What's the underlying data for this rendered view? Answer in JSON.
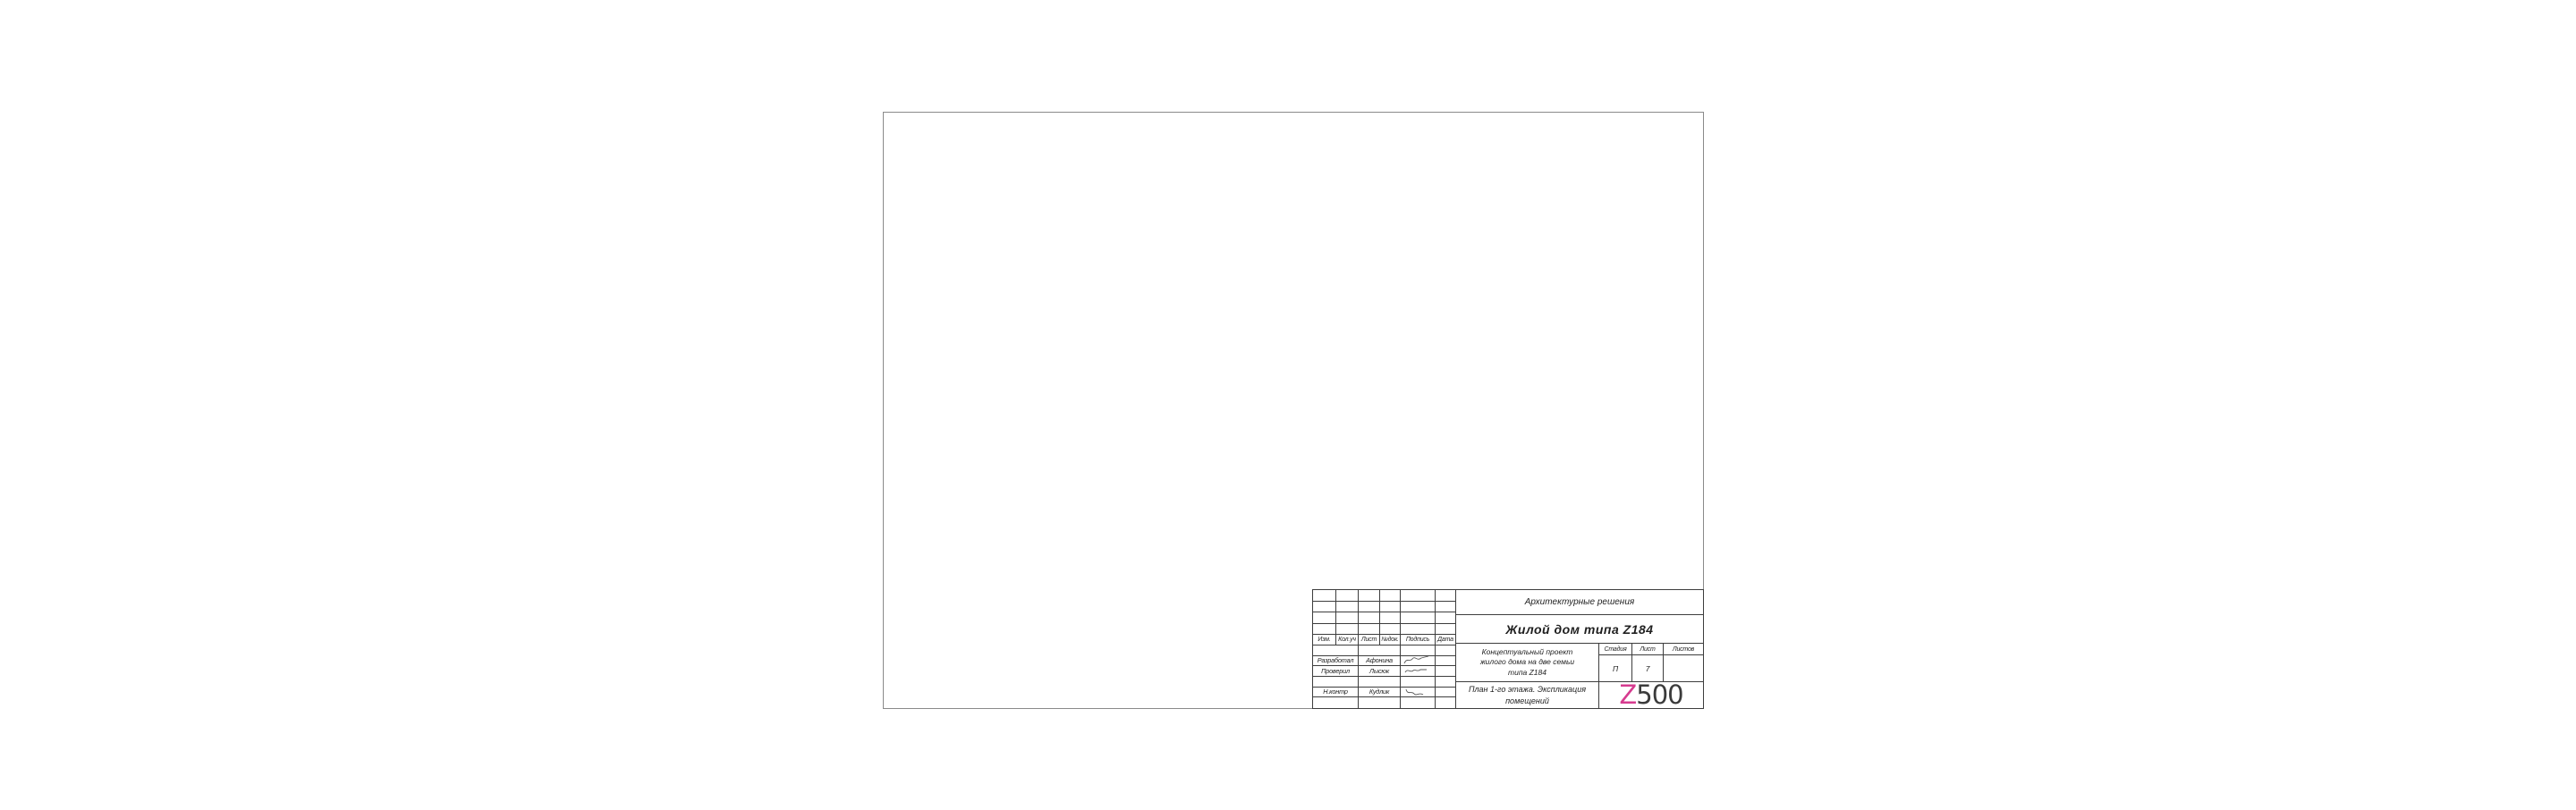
{
  "page": {
    "background": "#ffffff",
    "sheet_border_color": "#8a8a8a"
  },
  "title_block": {
    "line_color": "#3d3d3d",
    "discipline": "Архитектурные решения",
    "object_title": "Жилой дом типа Z184",
    "project_description_lines": [
      "Концептуальный проект",
      "жилого дома на две семьи",
      "типа Z184"
    ],
    "sheet_title_lines": [
      "План 1-го этажа. Экспликация",
      "помещений"
    ],
    "revision_headers": [
      "Изм.",
      "Кол.уч",
      "Лист",
      "№док.",
      "Подпись",
      "Дата"
    ],
    "staff": [
      {
        "role": "Разработал",
        "name": "Афонина",
        "signature_icon": "signature-scribble"
      },
      {
        "role": "Проверил",
        "name": "Лысюк",
        "signature_icon": "signature-scribble"
      },
      {
        "role": "Н.контр",
        "name": "Кудлик",
        "signature_icon": "signature-scribble"
      }
    ],
    "stage": {
      "label": "Стадия",
      "value": "П"
    },
    "sheet_number": {
      "label": "Лист",
      "value": "7"
    },
    "sheets_total": {
      "label": "Листов",
      "value": ""
    },
    "logo": {
      "prefix": "Z",
      "suffix": "500",
      "prefix_color": "#d63b8f",
      "suffix_color": "#3b3b3b"
    }
  }
}
